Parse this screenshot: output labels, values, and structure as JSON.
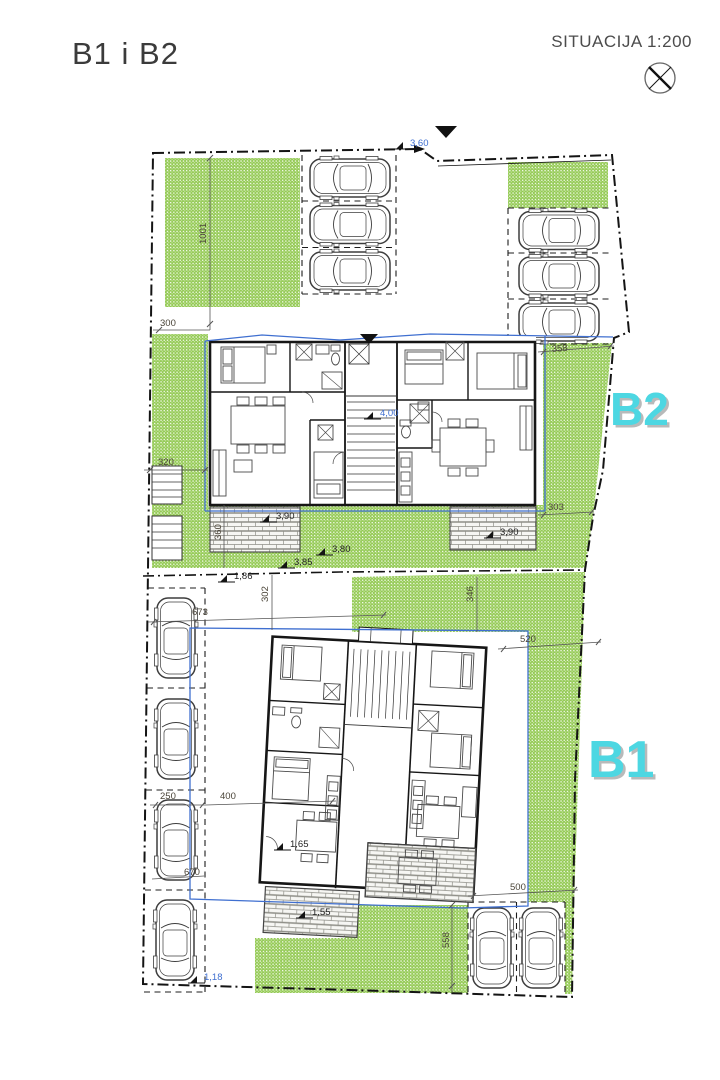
{
  "header": {
    "title": "B1 i B2",
    "scale_label": "SITUACIJA 1:200"
  },
  "buildings": {
    "b1": "B1",
    "b2": "B2"
  },
  "icons": {
    "north_symbol": "circle-with-cross",
    "entrance_marker": "filled-down-triangle",
    "level_marker": "spot-height-flag"
  },
  "colors": {
    "accent_cyan": "#4dd7e2",
    "grass_green": "#8dc63f",
    "envelope_blue": "#3f6fd0",
    "line_dark": "#1a1a1a"
  },
  "dims": {
    "h360": "3,60",
    "v1001": "1001",
    "w300": "300",
    "w320": "320",
    "v360": "360",
    "l400": "4,00",
    "w358": "358",
    "w303": "303",
    "l390a": "3,90",
    "l390b": "3,90",
    "l380": "3,80",
    "l385": "3,85",
    "l186": "1,86",
    "v302": "302",
    "w673": "673",
    "v346": "346",
    "w520": "520",
    "w250": "250",
    "w400": "400",
    "l165": "1,65",
    "w670": "670",
    "w500": "500",
    "l155": "1,55",
    "v558": "558",
    "l118": "1,18"
  }
}
